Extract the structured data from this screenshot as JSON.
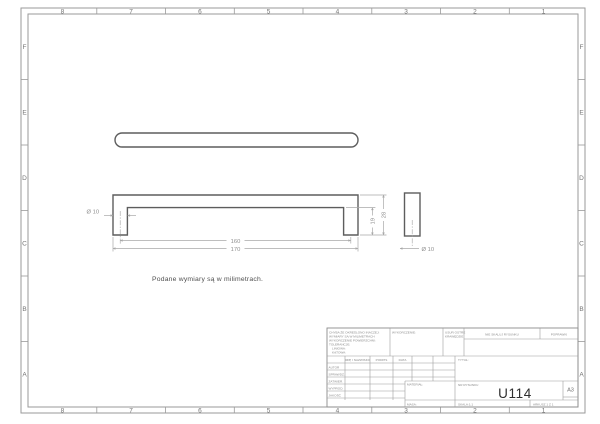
{
  "zones": {
    "columns": [
      "8",
      "7",
      "6",
      "5",
      "4",
      "3",
      "2",
      "1"
    ],
    "rows": [
      "F",
      "E",
      "D",
      "C",
      "B",
      "A"
    ]
  },
  "note": "Podane wymiary są w milimetrach.",
  "dims": {
    "front_hole": "Ø 10",
    "spacing": "160",
    "overall": "170",
    "leg": "19",
    "height": "28",
    "side_hole": "Ø 10"
  },
  "title_block": {
    "tolerance_lines": [
      "CHYBA ŻE OKREŚLONO INACZEJ:",
      "WYMIARY SĄ W MILIMETRACH",
      "WYKOŃCZENIE POWIERZCHNI:",
      "TOLERANCJE:",
      "LINIOWA:",
      "KĄTOWA:"
    ],
    "finish_label": "WYKOŃCZENIE:",
    "deburr_line1": "USUŃ OSTRE",
    "deburr_line2": "KRAWĘDZIE",
    "do_not_scale": "NIE SKALUJ RYSUNKU",
    "revision_label": "POPRAWKI",
    "name_header": "IMIĘ I NAZWISKO",
    "signature_header": "PODPIS",
    "date_header": "DATA",
    "rows": [
      "AUTOR",
      "SPRAWDZ.",
      "ZATWIER.",
      "WYPROD.",
      "JAKOŚĆ"
    ],
    "material_label": "MATERIAŁ:",
    "weight_label": "MASA:",
    "title_label": "TYTUŁ:",
    "dwg_label": "NR RYSUNKU",
    "dwg_number": "U114",
    "paper_size": "A3",
    "scale_label": "SKALA:1:1",
    "sheet_label": "ARKUSZ 1 Z 1"
  },
  "colors": {
    "part_line": "#5d5d5d",
    "dim_line": "#a8a8a8",
    "frame_line": "#9a9a9a",
    "drawing_number_text": "#2e2e2e"
  }
}
